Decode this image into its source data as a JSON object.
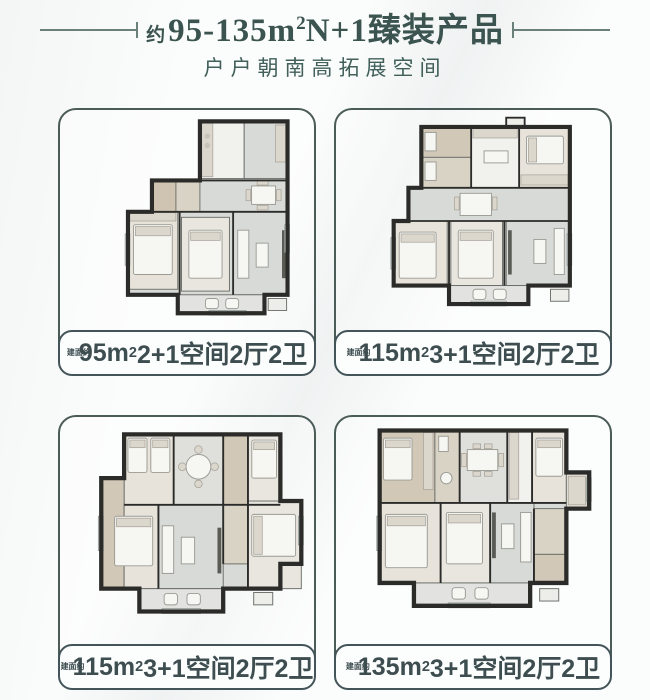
{
  "header": {
    "title_prefix": "约",
    "title_main": "95-135m",
    "title_sup": "2",
    "title_suffix": "N+1臻装产品",
    "subtitle": "户户朝南高拓展空间"
  },
  "theme": {
    "accent_text": "#3b544f",
    "card_border": "#4a5b58",
    "label_border": "#44555a",
    "background": "#fbfcfc",
    "wall_color": "#2b2b29"
  },
  "units": [
    {
      "area_prefix": "建面约",
      "area_value": "95m",
      "area_sup": "2",
      "layout": "2+1空间2厅2卫"
    },
    {
      "area_prefix": "建面约",
      "area_value": "115m",
      "area_sup": "2",
      "layout": "3+1空间2厅2卫"
    },
    {
      "area_prefix": "建面约",
      "area_value": "115m",
      "area_sup": "2",
      "layout": "3+1空间2厅2卫"
    },
    {
      "area_prefix": "建面约",
      "area_value": "135m",
      "area_sup": "2",
      "layout": "3+1空间2厅2卫"
    }
  ]
}
